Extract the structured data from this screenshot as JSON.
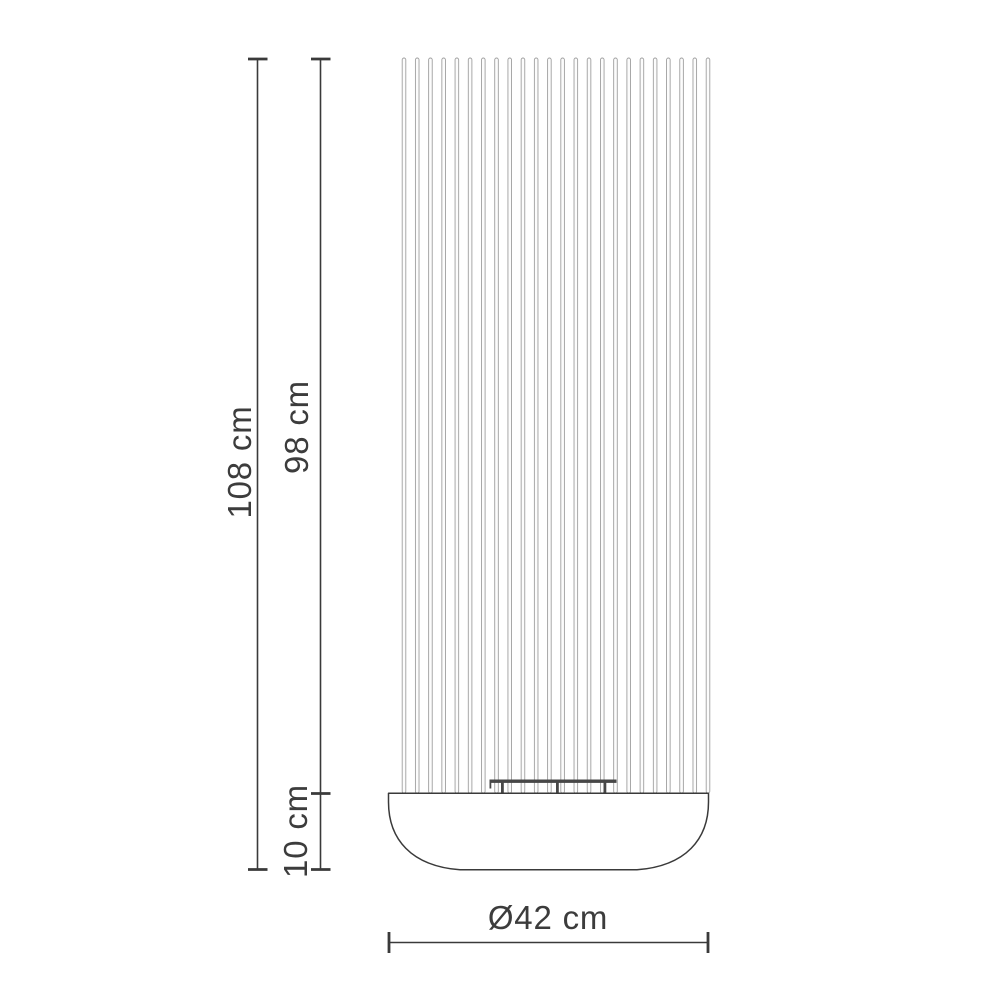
{
  "diagram": {
    "kind": "product-dimension-drawing"
  },
  "dimensions": {
    "total_height_label": "108 cm",
    "rod_section_height_label": "98 cm",
    "base_height_label": "10 cm",
    "diameter_label": "Ø42 cm"
  },
  "drawing": {
    "rod_count": 24
  },
  "colors": {
    "background": "#ffffff",
    "dim_line": "#3a3a3a",
    "outline": "#3a3a3a",
    "rod_stroke": "#9f9f9f",
    "rod_fill": "#fcfcfc",
    "bracket": "#474747",
    "label_text": "#3c3c3c"
  }
}
